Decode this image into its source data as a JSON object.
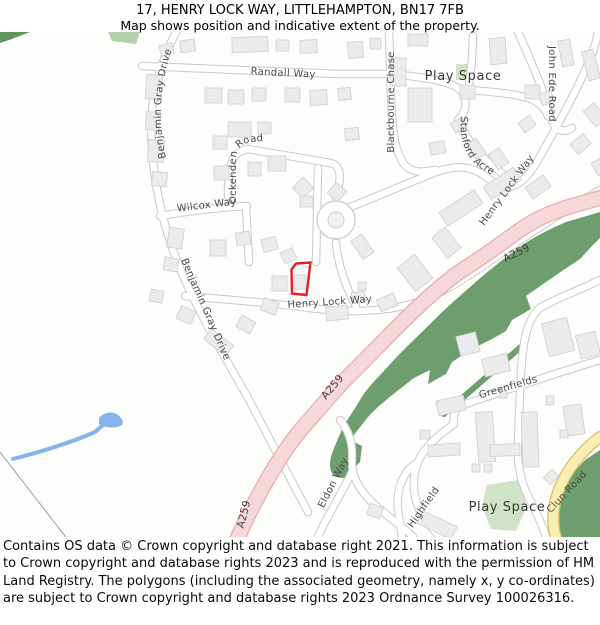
{
  "header": {
    "title": "17, HENRY LOCK WAY, LITTLEHAMPTON, BN17 7FB",
    "subtitle": "Map shows position and indicative extent of the property."
  },
  "map": {
    "road_labels": {
      "randall": "Randall Way",
      "benjamin_top": "Benjamin Gray Drive",
      "benjamin_lower": "Benjamin Gray Drive",
      "ockenden": "Ockenden Road",
      "wilcox": "Wilcox Way",
      "blackbourne": "Blackbourne Chase",
      "john_ede": "John Ede Road",
      "stanford": "Stanford Acre",
      "henry_lock_ne": "Henry Lock Way",
      "henry_lock_main": "Henry Lock Way",
      "eldon": "Eldon Way",
      "highfield": "Highfield",
      "greenfields": "Greenfields",
      "clun": "Clun Road"
    },
    "route_labels": {
      "a259_south": "A259",
      "a259_mid": "A259",
      "a259_north": "A259"
    },
    "area_labels": {
      "play_space_top": "Play Space",
      "play_space_bottom": "Play Space"
    },
    "colors": {
      "property_outline": "#ee1b23",
      "a_road_fill": "#f6d8da",
      "a_road_casing": "#eaadb0",
      "yellow_road_fill": "#faeeb4",
      "yellow_road_casing": "#dbbf62",
      "woodland": "#6d9e6d",
      "play_space_green": "#cfe3c6",
      "water": "#85b5e8"
    }
  },
  "footer": {
    "copyright": "Contains OS data © Crown copyright and database right 2021. This information is subject to Crown copyright and database rights 2023 and is reproduced with the permission of HM Land Registry. The polygons (including the associated geometry, namely x, y co-ordinates) are subject to Crown copyright and database rights 2023 Ordnance Survey 100026316."
  }
}
